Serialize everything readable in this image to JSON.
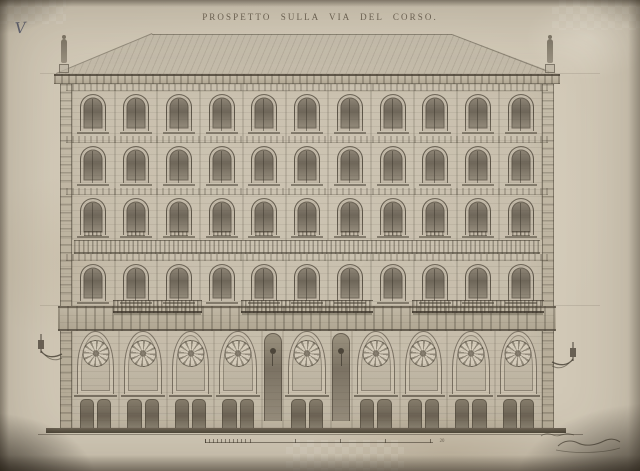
{
  "title": "PROSPETTO SULLA VIA DEL CORSO.",
  "annotations": {
    "sheet_number": "V",
    "signature": "illegible handwritten inscription at bottom right"
  },
  "scale_bar": {
    "end_label": "20",
    "major_ticks": 6
  },
  "colors": {
    "paper": "#d1c8b6",
    "ink": "#4b4437",
    "vignette": "#2a2219"
  },
  "facade": {
    "subject": "palazzo street elevation",
    "upper_window_rows": 4,
    "bays_per_row": 11,
    "ground_bays": [
      "arch",
      "arch",
      "arch",
      "arch",
      "niche",
      "arch",
      "niche",
      "arch",
      "arch",
      "arch",
      "arch"
    ],
    "balcony_bay_ranges": [
      [
        1,
        2
      ],
      [
        4,
        6
      ],
      [
        8,
        10
      ]
    ],
    "roof_statues": 2,
    "wall_lamps": 2
  }
}
